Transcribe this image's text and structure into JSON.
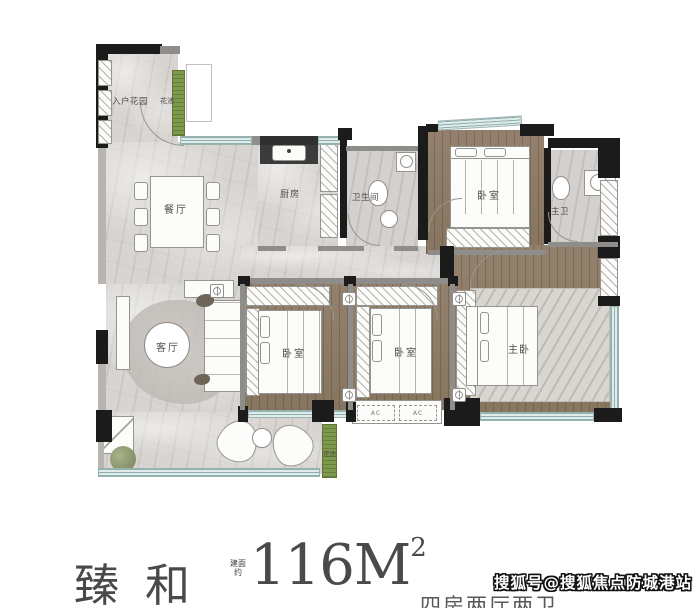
{
  "page": {
    "type": "apartment-floor-plan"
  },
  "rooms": {
    "entry_garden": "入户花园",
    "flower_bed_top": "花池",
    "dining_room": "餐厅",
    "kitchen": "厨房",
    "bathroom": "卫生间",
    "bedroom_top": "卧室",
    "master_bathroom": "主卫",
    "living_room": "客厅",
    "bedroom_left": "卧室",
    "bedroom_middle": "卧室",
    "master_bedroom": "主卧",
    "flower_bed_bottom": "花池",
    "ac_label": "AC"
  },
  "footer": {
    "plan_name": "臻和",
    "area_prefix_line1": "建面",
    "area_prefix_line2": "约",
    "area_value": "116M",
    "area_exponent": "2",
    "layout_description": "四房两厅两卫"
  },
  "watermark": "搜狐号@搜狐焦点防城港站",
  "colors": {
    "wall": "#1b1b1b",
    "marble_floor": "#d7d4d1",
    "wood_floor": "#8d7b69",
    "window": "#cfe0df",
    "plant_green": "#7d9a4c",
    "title_text": "#4a4a4c"
  }
}
